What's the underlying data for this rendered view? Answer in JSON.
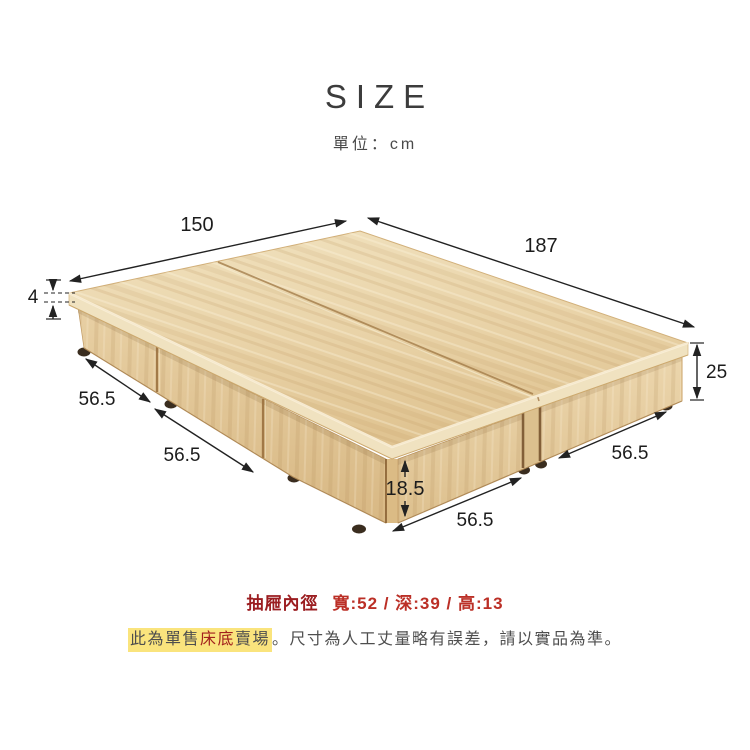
{
  "header": {
    "title": "SIZE",
    "unit": "單位：cm"
  },
  "diagram": {
    "type": "bed-base-3d-dimension-diagram",
    "unit": "cm",
    "dims": {
      "length": "150",
      "width": "187",
      "top_thickness": "4",
      "total_height": "25",
      "drawer_w1": "56.5",
      "drawer_w2": "56.5",
      "drawer_w3": "56.5",
      "drawer_w4": "56.5",
      "face_height": "18.5"
    }
  },
  "footer": {
    "drawer_label": "抽屜內徑",
    "drawer_value": "寬:52 / 深:39 / 高:13",
    "note_pre": "此為單售",
    "note_red": "床底",
    "note_mid": "賣場",
    "note_rest": "。尺寸為人工丈量略有誤差，請以實品為準。"
  },
  "colors": {
    "dimension_ink": "#222222",
    "spec_label_red": "#9b1d20",
    "spec_value_red": "#bb2f26",
    "note_gray": "#4e4e4e",
    "note_red": "#a2201d",
    "highlight_yellow": "#fae47d",
    "wood_light": "#f1e2bf",
    "wood_dark": "#d9ba87"
  }
}
